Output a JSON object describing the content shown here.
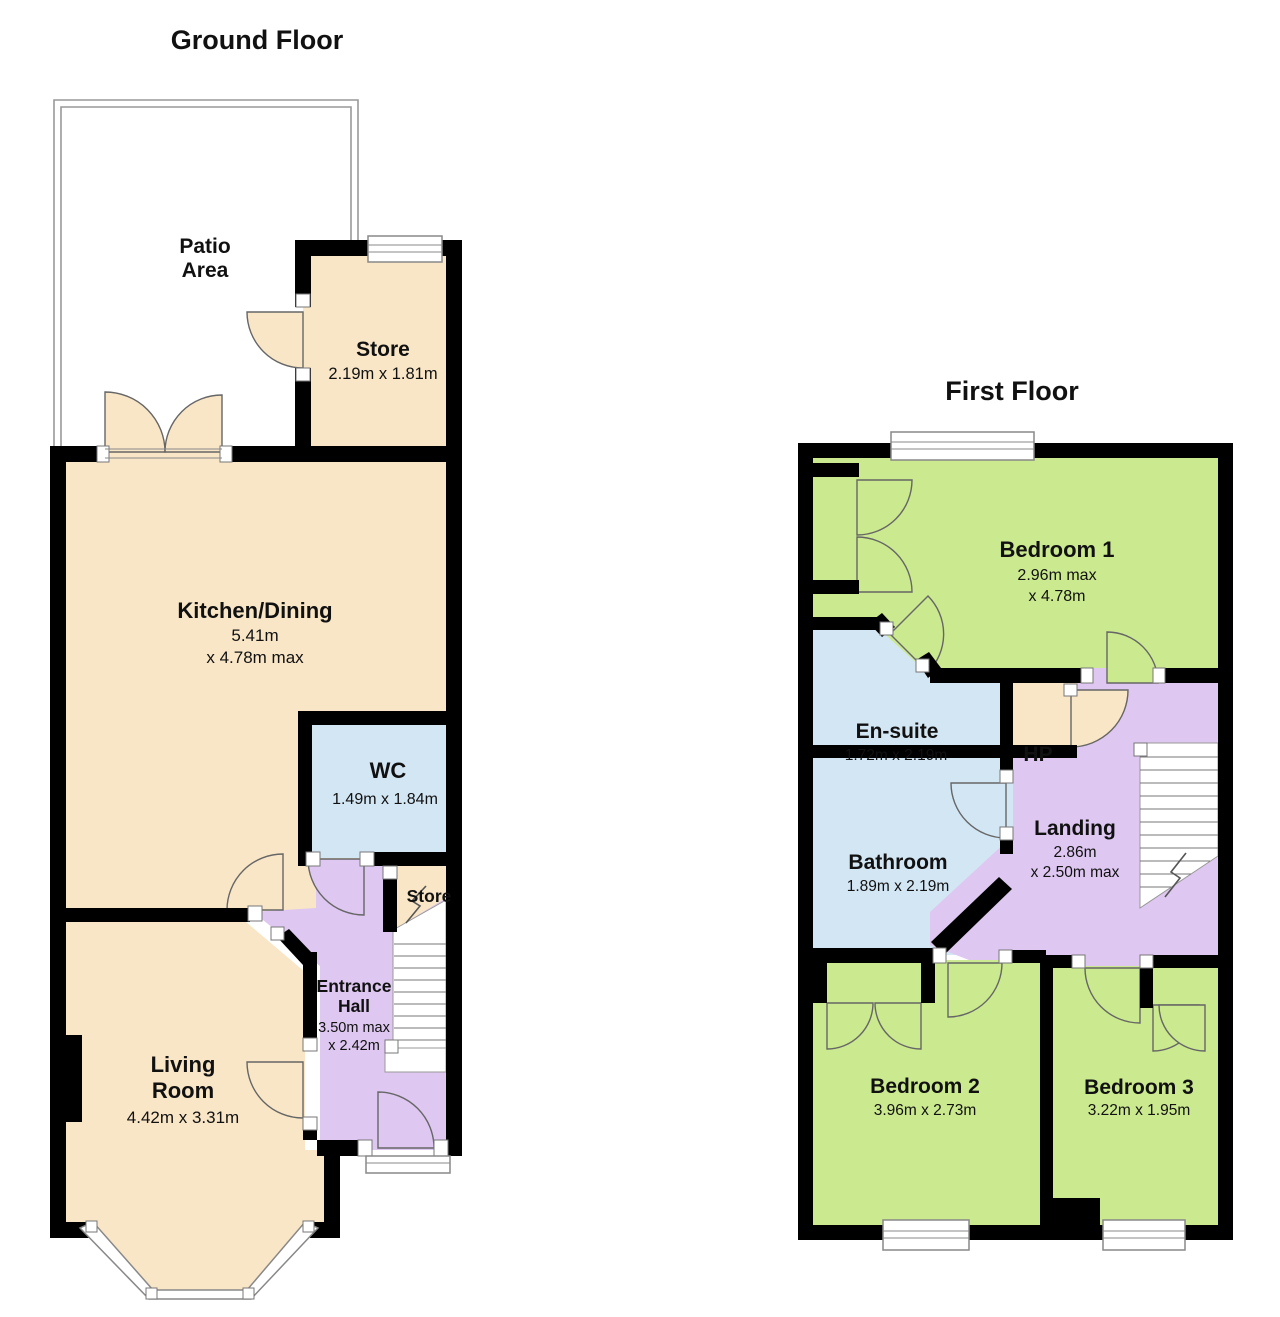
{
  "meta": {
    "type": "estate-agent floor plan",
    "colors": {
      "wall": "#000000",
      "room_beige": "#F9E6C7",
      "room_green": "#CBE98F",
      "room_blue": "#D3E6F4",
      "room_purple": "#DEC7F0",
      "outline_grey": "#999999",
      "text": "#111111",
      "background": "#FFFFFF"
    }
  },
  "ground_floor": {
    "title": "Ground Floor",
    "patio": {
      "line1": "Patio",
      "line2": "Area"
    },
    "store_top": {
      "name": "Store",
      "dims": "2.19m x 1.81m"
    },
    "kitchen": {
      "name": "Kitchen/Dining",
      "dim1": "5.41m",
      "dim2": "x 4.78m max"
    },
    "wc": {
      "name": "WC",
      "dims": "1.49m x 1.84m"
    },
    "store_small": {
      "name": "Store"
    },
    "entrance_hall": {
      "line1": "Entrance",
      "line2": "Hall",
      "dim1": "3.50m max",
      "dim2": "x 2.42m"
    },
    "living": {
      "line1": "Living",
      "line2": "Room",
      "dims": "4.42m x 3.31m"
    }
  },
  "first_floor": {
    "title": "First Floor",
    "bedroom1": {
      "name": "Bedroom 1",
      "dim1": "2.96m max",
      "dim2": "x 4.78m"
    },
    "ensuite": {
      "name": "En-suite",
      "dims": "1.72m x 2.19m"
    },
    "hp": {
      "name": "HP"
    },
    "landing": {
      "name": "Landing",
      "dim1": "2.86m",
      "dim2": "x 2.50m max"
    },
    "bathroom": {
      "name": "Bathroom",
      "dims": "1.89m x 2.19m"
    },
    "bedroom2": {
      "name": "Bedroom 2",
      "dims": "3.96m x 2.73m"
    },
    "bedroom3": {
      "name": "Bedroom 3",
      "dims": "3.22m x 1.95m"
    }
  }
}
